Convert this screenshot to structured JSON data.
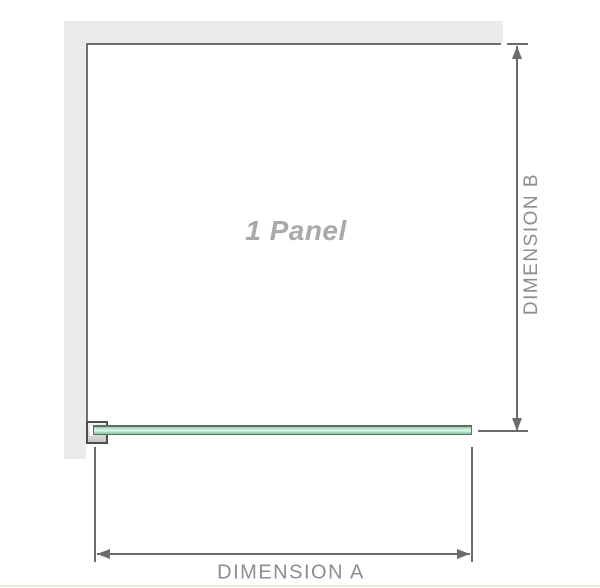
{
  "diagram": {
    "panel_label": "1 Panel",
    "dimension_a_label": "DIMENSION A",
    "dimension_b_label": "DIMENSION B"
  },
  "icons": [
    {
      "name": "arrow-up-icon",
      "meaning": "dimension B upper arrowhead"
    },
    {
      "name": "arrow-down-icon",
      "meaning": "dimension B lower arrowhead"
    },
    {
      "name": "arrow-left-icon",
      "meaning": "dimension A left arrowhead"
    },
    {
      "name": "arrow-right-icon",
      "meaning": "dimension A right arrowhead"
    }
  ],
  "colors": {
    "wall_fill": "#ebebed",
    "panel_outline": "#6f6f6f",
    "dimension_line": "#6a6d6f",
    "dimension_label_text": "#8b8e91",
    "panel_label_text": "#a7a9ac",
    "glass_green_light": "#e0f2e6",
    "glass_green_mid": "#96cfae",
    "glass_edge": "#5d6e62",
    "bracket_fill": "#dedede",
    "bracket_border": "#4d4d4d",
    "bottom_rule": "#f0ead9"
  }
}
